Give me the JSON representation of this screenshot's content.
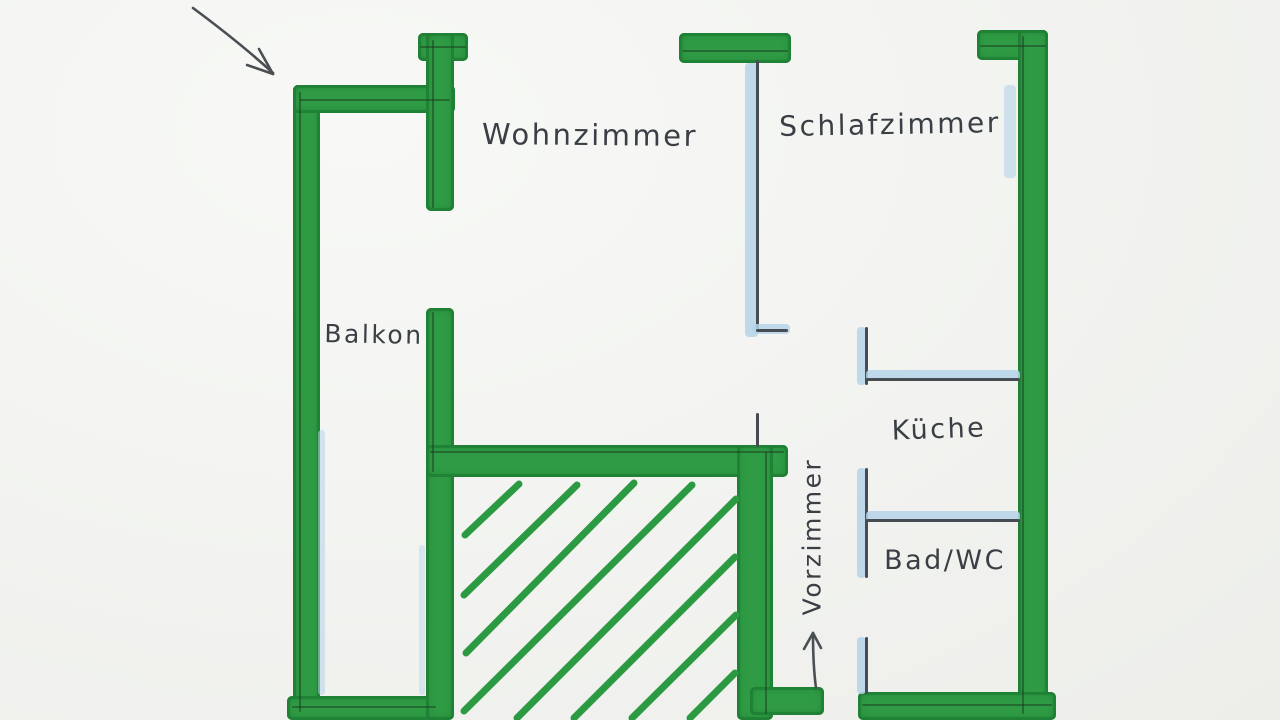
{
  "title": "Hand-drawn apartment floor plan",
  "rooms": {
    "wohnzimmer": "Wohnzimmer",
    "schlafzimmer": "Schlafzimmer",
    "balkon": "Balkon",
    "kueche": "Küche",
    "bad": "Bad/WC",
    "vorzimmer": "Vorzimmer"
  },
  "annotations": {
    "balcony_pointer_arrow": "arrow pointing down-right at balcony corner",
    "entrance_arrow": "arrow pointing up through entrance door"
  },
  "colors": {
    "marker_green": "#2f9c45",
    "marker_green_edge": "#1a7830",
    "marker_light_blue": "#b5d4e9",
    "pencil_gray": "#474c52",
    "paper": "#f3f4f1"
  }
}
